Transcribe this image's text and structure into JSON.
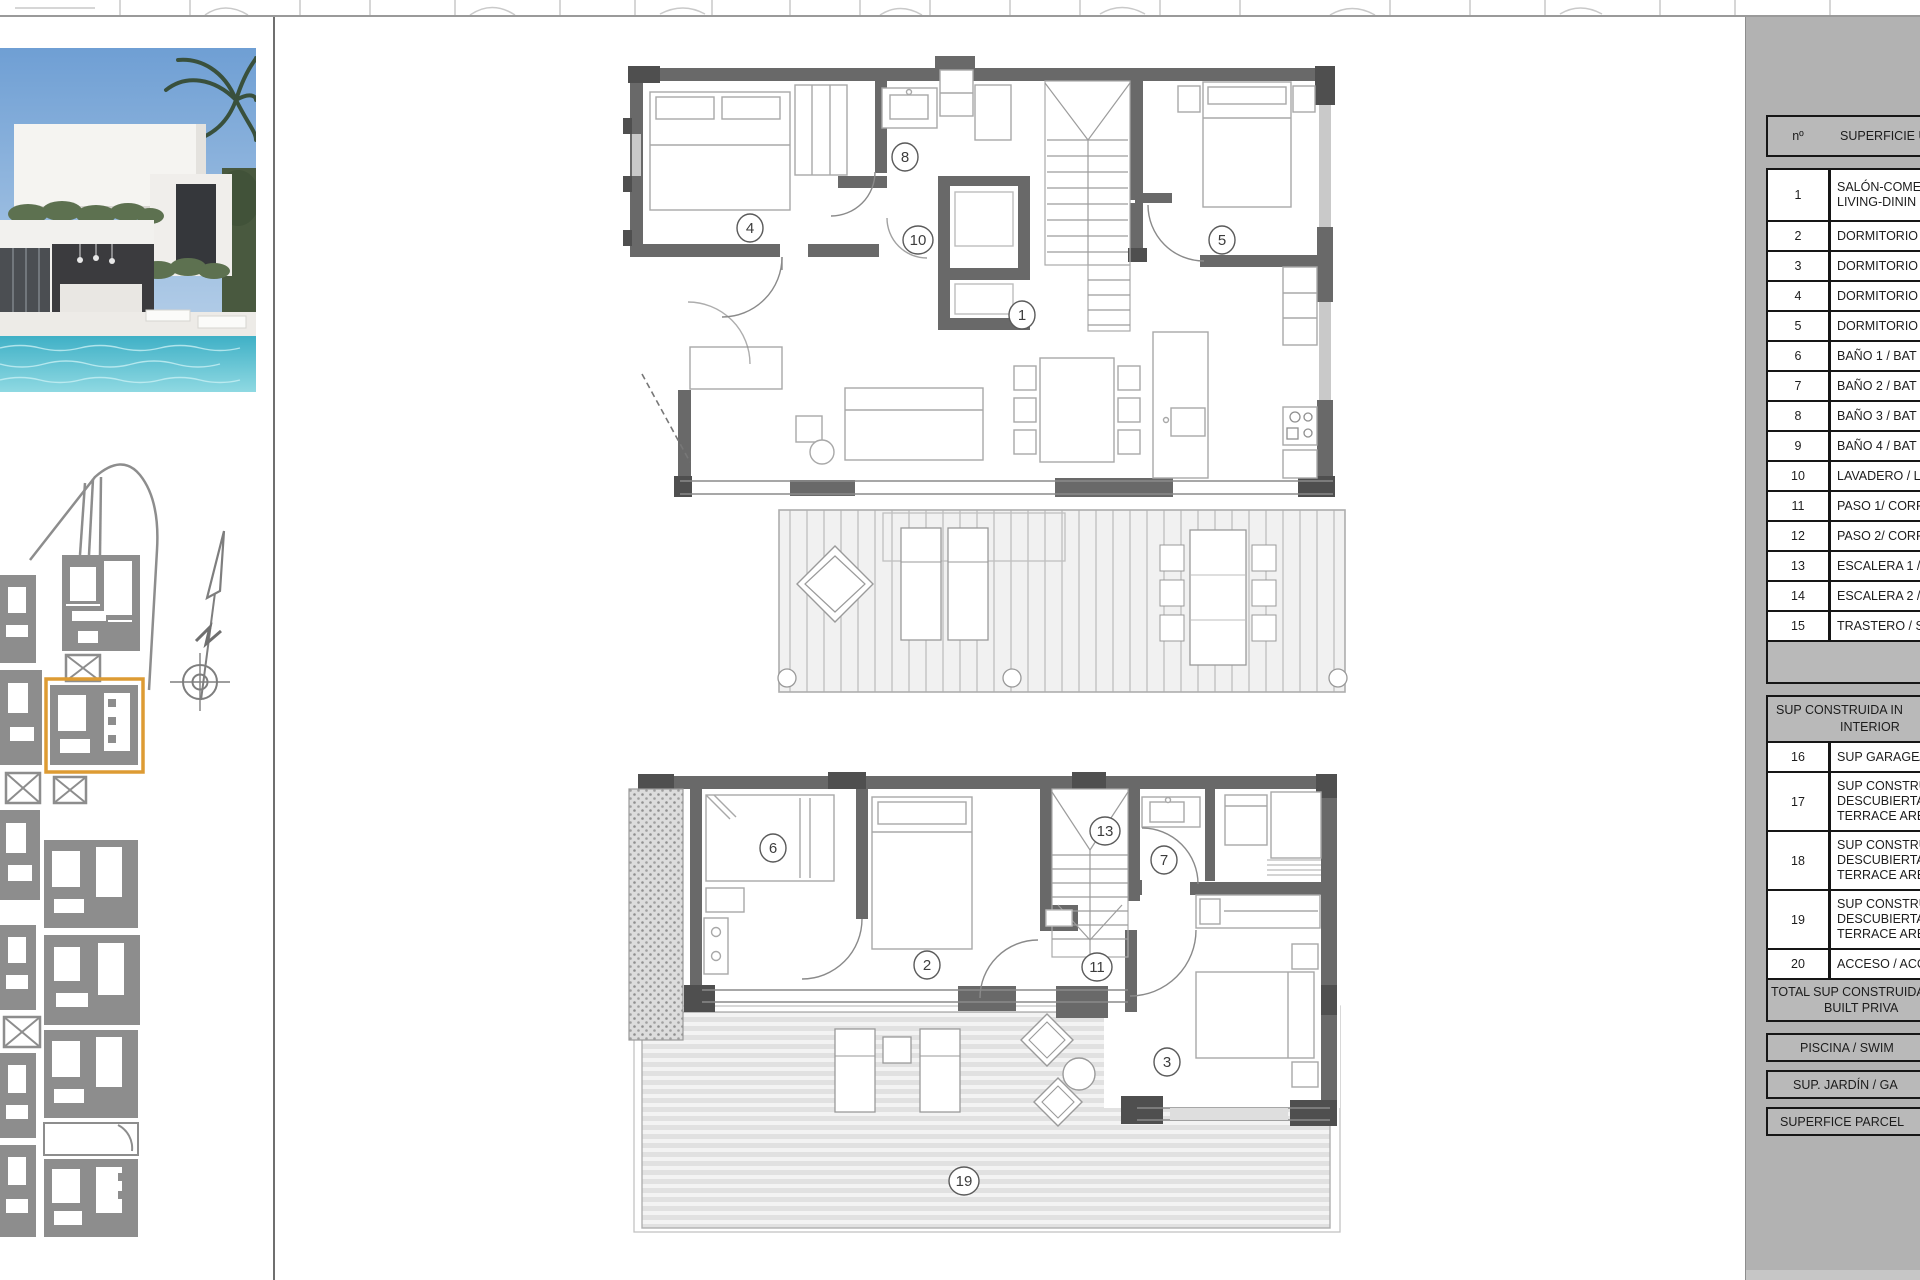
{
  "plans": {
    "upper": {
      "labels": {
        "living": "1",
        "bedroom4": "4",
        "bedroom5": "5",
        "bath8": "8",
        "laundry10": "10"
      }
    },
    "lower": {
      "labels": {
        "bedroom2": "2",
        "bedroom3": "3",
        "bath6": "6",
        "bath7": "7",
        "hall11": "11",
        "stairs13": "13",
        "terrace19": "19"
      }
    }
  },
  "table": {
    "header": {
      "num": "nº",
      "desc": "SUPERFICIE Ú"
    },
    "rows": [
      {
        "num": "1",
        "line1": "SALÓN-COME",
        "line2": "LIVING-DININ"
      },
      {
        "num": "2",
        "line1": "DORMITORIO"
      },
      {
        "num": "3",
        "line1": "DORMITORIO"
      },
      {
        "num": "4",
        "line1": "DORMITORIO"
      },
      {
        "num": "5",
        "line1": "DORMITORIO"
      },
      {
        "num": "6",
        "line1": "BAÑO 1 / BAT"
      },
      {
        "num": "7",
        "line1": "BAÑO 2 / BAT"
      },
      {
        "num": "8",
        "line1": "BAÑO 3 / BAT"
      },
      {
        "num": "9",
        "line1": "BAÑO 4 / BAT"
      },
      {
        "num": "10",
        "line1": "LAVADERO / L"
      },
      {
        "num": "11",
        "line1": "PASO 1/ CORR"
      },
      {
        "num": "12",
        "line1": "PASO 2/ CORR"
      },
      {
        "num": "13",
        "line1": "ESCALERA 1 /"
      },
      {
        "num": "14",
        "line1": "ESCALERA 2 /"
      },
      {
        "num": "15",
        "line1": "TRASTERO / S"
      }
    ],
    "section2": {
      "header_line1": "SUP CONSTRUIDA IN",
      "header_line2": "INTERIOR",
      "rows": [
        {
          "num": "16",
          "l1": "SUP GARAGE/"
        },
        {
          "num": "17",
          "l1": "SUP CONSTRU",
          "l2": "DESCUBIERTA",
          "l3": "TERRACE AREA"
        },
        {
          "num": "18",
          "l1": "SUP CONSTRU",
          "l2": "DESCUBIERTA",
          "l3": "TERRACE AREA"
        },
        {
          "num": "19",
          "l1": "SUP CONSTRU",
          "l2": "DESCUBIERTA",
          "l3": "TERRACE AREA"
        },
        {
          "num": "20",
          "l1": "ACCESO / ACC"
        }
      ]
    },
    "total": {
      "line1": "TOTAL SUP CONSTRUIDA",
      "line2": "BUILT PRIVA"
    },
    "footers": {
      "piscina": "PISCINA / SWIM",
      "jardin": "SUP. JARDÍN / GA",
      "parcela": "SUPERFICE PARCEL"
    }
  },
  "colors": {
    "panel_gray": "#b2b2b2",
    "cell_gray": "#b9b9b9",
    "border_dark": "#161616",
    "wall_gray": "#696969",
    "wall_dark": "#4f4f4f",
    "site_gray": "#8d8d8d",
    "highlight_orange": "#dd9b33",
    "terrace_stripe": "#e3e3e3",
    "pool_blue": "#4db9cb",
    "sky_blue": "#7fa9d8"
  }
}
